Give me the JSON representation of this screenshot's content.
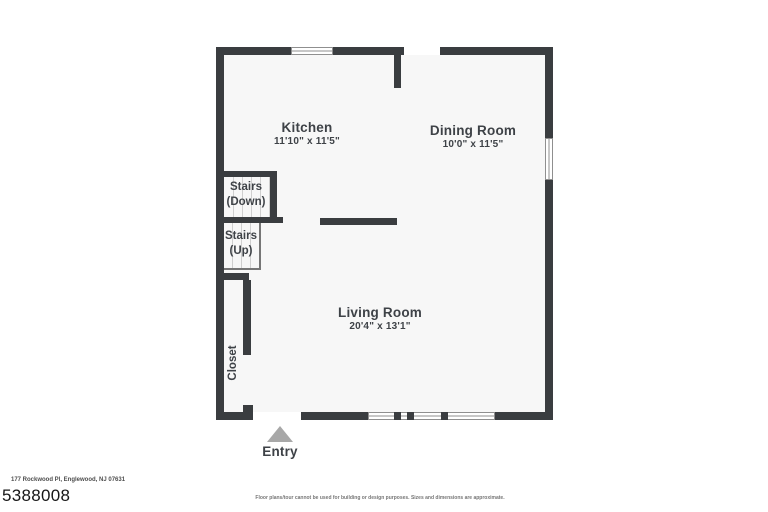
{
  "page": {
    "address": "177 Rockwood Pl, Englewood, NJ 07631",
    "listing_id": "5388008",
    "disclaimer": "Floor plans/tour cannot be used for building or design purposes. Sizes and dimensions are approximate."
  },
  "floorplan": {
    "rooms": {
      "kitchen": {
        "name": "Kitchen",
        "dims": "11'10\" x 11'5\""
      },
      "dining_room": {
        "name": "Dining Room",
        "dims": "10'0\" x 11'5\""
      },
      "living_room": {
        "name": "Living Room",
        "dims": "20'4\" x 13'1\""
      },
      "stairs_down": {
        "line1": "Stairs",
        "line2": "(Down)"
      },
      "stairs_up": {
        "line1": "Stairs",
        "line2": "(Up)"
      },
      "closet": {
        "name": "Closet"
      },
      "entry": {
        "name": "Entry"
      }
    },
    "colors": {
      "wall": "#3a3d40",
      "floor": "#f7f7f7",
      "text": "#3e4247",
      "entry_arrow": "#a8a8a8",
      "stair_tread": "#cfcfcf",
      "window_frame": "#8f8f8f"
    }
  }
}
